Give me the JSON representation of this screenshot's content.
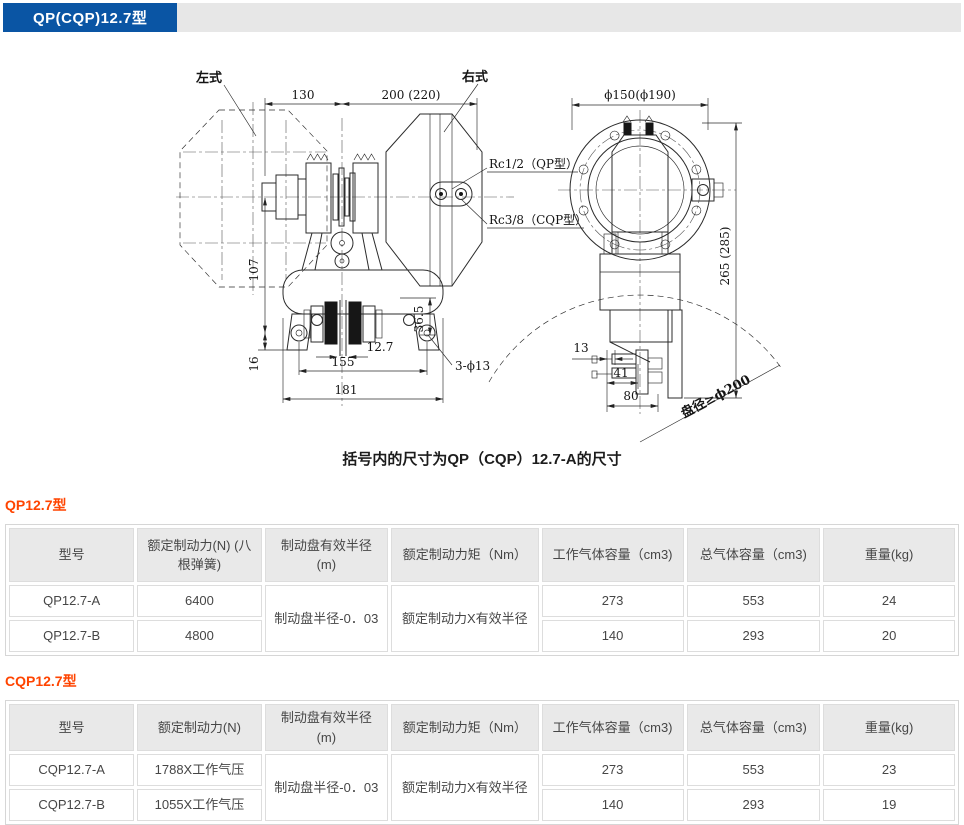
{
  "header": {
    "title": "QP(CQP)12.7型"
  },
  "drawing": {
    "caption": "括号内的尺寸为QP（CQP）12.7-A的尺寸",
    "labels": {
      "left_type": "左式",
      "right_type": "右式",
      "dim_130": "130",
      "dim_200": "200 (220)",
      "rc_qp": "Rc1/2（QP型）",
      "rc_cqp": "Rc3/8（CQP型）",
      "dia_150": "ϕ150(ϕ190)",
      "dim_265": "265 (285)",
      "dim_107": "107",
      "dim_16": "16",
      "dim_36_5": "36.5",
      "dim_12_7": "12.7",
      "dim_155": "155",
      "dim_181": "181",
      "holes": "3-ϕ13",
      "dim_13": "13",
      "dim_41": "41",
      "dim_80": "80",
      "disc_dia": "盘径≥ϕ200"
    }
  },
  "tables": [
    {
      "heading": "QP12.7型",
      "columns": [
        "型号",
        "额定制动力(N) (八根弹簧)",
        "制动盘有效半径(m)",
        "额定制动力矩（Nm）",
        "工作气体容量（cm3)",
        "总气体容量（cm3)",
        "重量(kg)"
      ],
      "merged": {
        "radius": "制动盘半径-0．03",
        "torque": "额定制动力X有效半径"
      },
      "rows": [
        {
          "model": "QP12.7-A",
          "force": "6400",
          "work_vol": "273",
          "total_vol": "553",
          "weight": "24"
        },
        {
          "model": "QP12.7-B",
          "force": "4800",
          "work_vol": "140",
          "total_vol": "293",
          "weight": "20"
        }
      ]
    },
    {
      "heading": "CQP12.7型",
      "columns": [
        "型号",
        "额定制动力(N)",
        "制动盘有效半径(m)",
        "额定制动力矩（Nm）",
        "工作气体容量（cm3)",
        "总气体容量（cm3)",
        "重量(kg)"
      ],
      "merged": {
        "radius": "制动盘半径-0．03",
        "torque": "额定制动力X有效半径"
      },
      "rows": [
        {
          "model": "CQP12.7-A",
          "force": "1788X工作气压",
          "work_vol": "273",
          "total_vol": "553",
          "weight": "23"
        },
        {
          "model": "CQP12.7-B",
          "force": "1055X工作气压",
          "work_vol": "140",
          "total_vol": "293",
          "weight": "19"
        }
      ]
    }
  ],
  "colors": {
    "brand_blue": "#0a55a4",
    "accent_orange": "#ff4400",
    "bar_gray": "#e7e7e7",
    "table_header_gray": "#e9e9e9"
  }
}
